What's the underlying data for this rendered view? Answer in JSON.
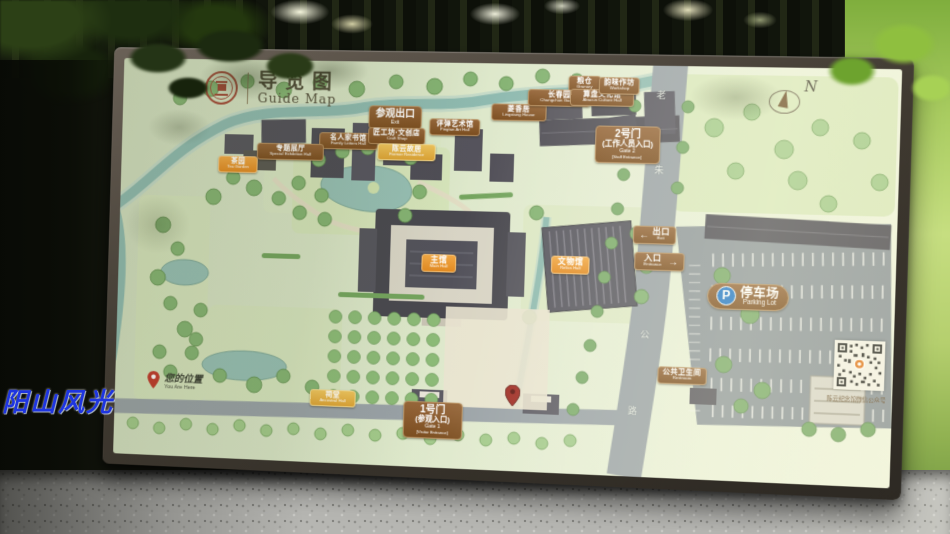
{
  "watermark": {
    "text": "阳山风光"
  },
  "board": {
    "header": {
      "title_zh": "导览图",
      "title_en": "Guide Map"
    },
    "compass": {
      "label": "N"
    },
    "road": {
      "name_chars": [
        "老",
        "朱",
        "公",
        "路"
      ]
    },
    "you_are_here": {
      "zh": "您的位置",
      "en": "You Are Here"
    },
    "qr": {
      "caption": "陈云纪念馆微信公众号"
    },
    "gates": {
      "gate1": {
        "line1": "1号门",
        "line2": "(参观入口)",
        "line3": "Gate 1",
        "line4": "[Visitor Entrance]"
      },
      "gate2": {
        "line1": "2号门",
        "line2": "(工作人员入口)",
        "line3": "Gate 2",
        "line4": "[Staff Entrance]"
      },
      "exit": {
        "arrow": "←",
        "zh": "出口",
        "en": "Exit"
      },
      "entrance": {
        "arrow": "→",
        "zh": "入口",
        "en": "Entrance"
      }
    },
    "parking": {
      "p": "P",
      "zh": "停车场",
      "en": "Parking Lot"
    },
    "pois": {
      "visitor_exit": {
        "zh": "参观出口",
        "en": "Exit"
      },
      "letters_hall": {
        "zh": "名人家书馆",
        "en": "Family Letters Hall"
      },
      "craft_shop": {
        "zh": "匠工坊·文创店",
        "en": "Craft Shop"
      },
      "pingtan_hall": {
        "zh": "评弹艺术馆",
        "en": "Pingtan Art Hall"
      },
      "residence": {
        "zh": "陈云故居",
        "en": "Former Residence"
      },
      "lingxiang_house": {
        "zh": "菱香居",
        "en": "Lingxiang House"
      },
      "granary": {
        "zh": "粮仓",
        "en": "Granary"
      },
      "changchun_garden": {
        "zh": "长春园",
        "en": "Changchun Garden"
      },
      "abacus_hall": {
        "zh": "算盘文化馆",
        "en": "Abacus Culture Hall"
      },
      "workshop": {
        "zh": "韵味作坊",
        "en": "Workshop"
      },
      "special_hall": {
        "zh": "专题展厅",
        "en": "Special Exhibition Hall"
      },
      "tea_garden": {
        "zh": "茶园",
        "en": "Tea Garden"
      },
      "main_hall": {
        "zh": "主馆",
        "en": "Main Hall"
      },
      "relics_hall": {
        "zh": "文物馆",
        "en": "Relics Hall"
      },
      "ancestral_hall": {
        "zh": "祠堂",
        "en": "Ancestral Hall"
      },
      "restroom": {
        "zh": "公共卫生间",
        "en": "Restroom"
      }
    }
  }
}
